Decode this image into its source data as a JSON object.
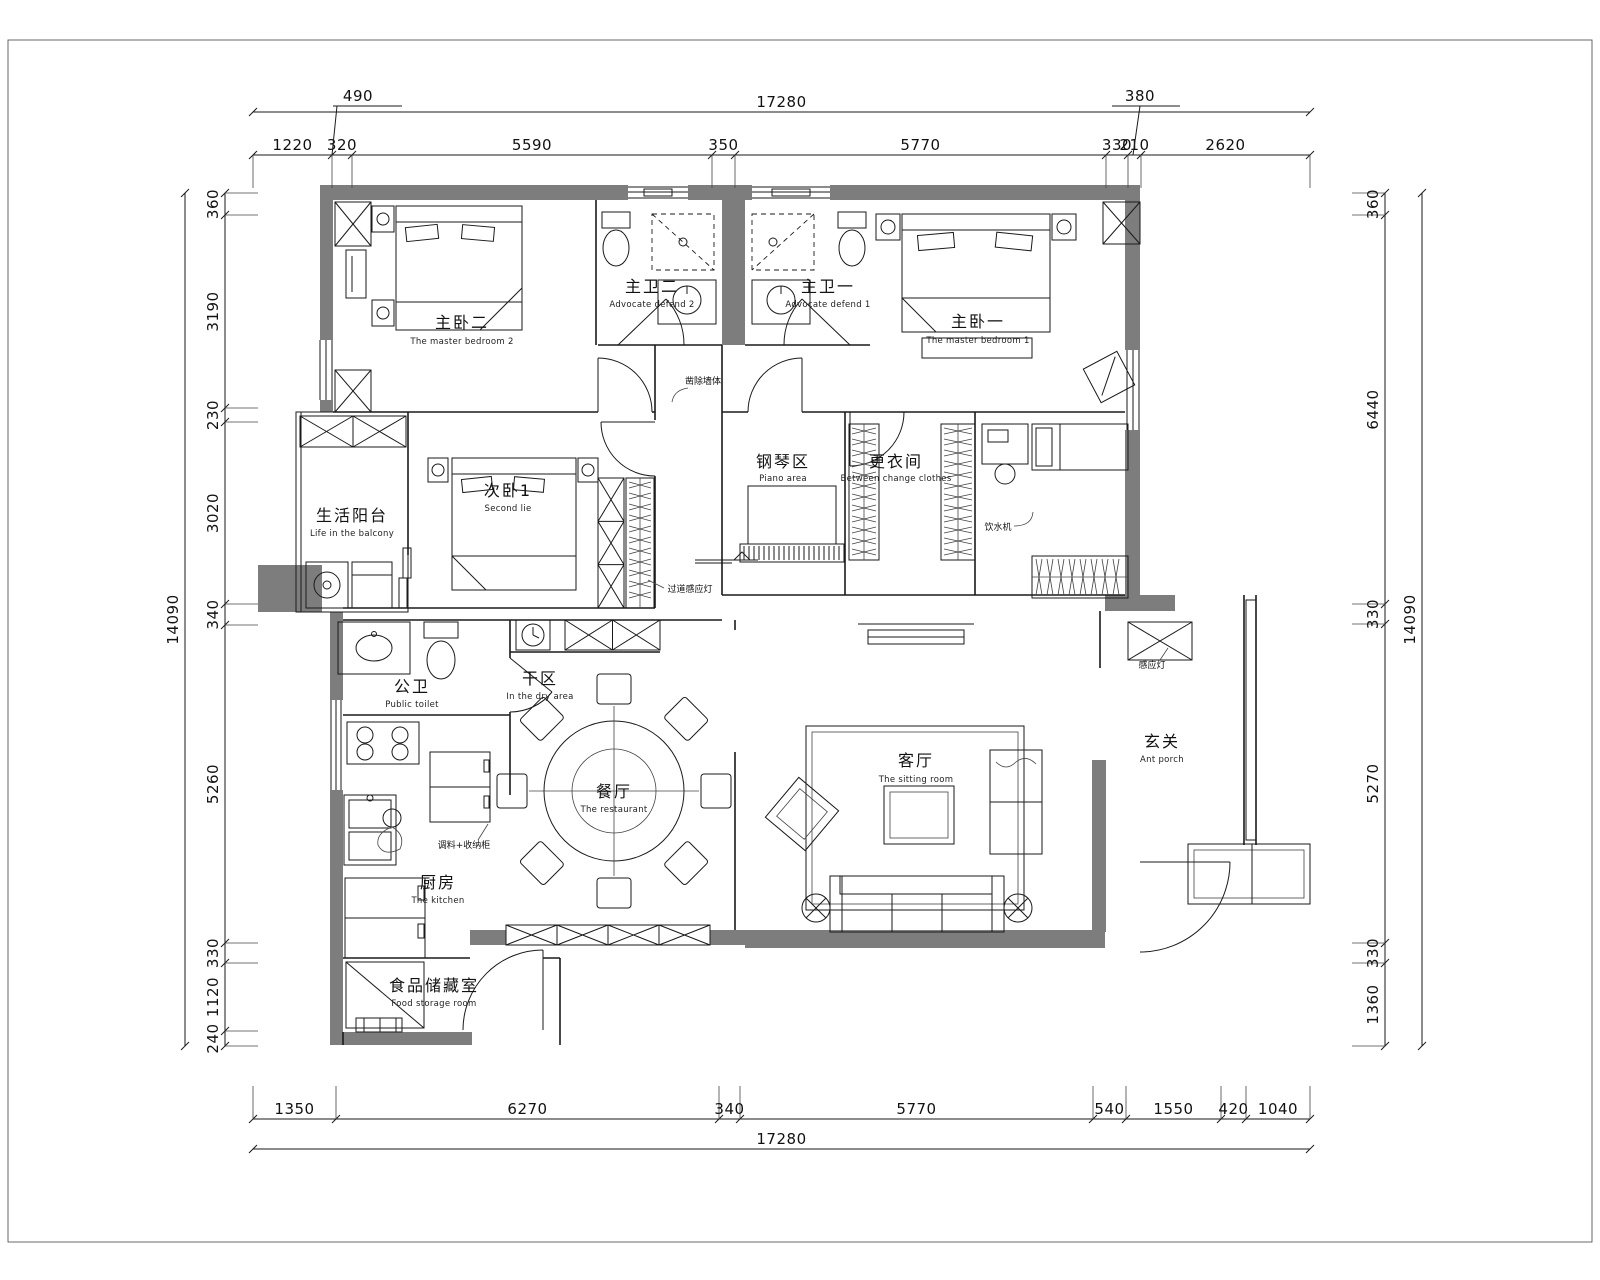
{
  "drawing": {
    "type": "residential-floor-plan",
    "units": "mm",
    "colors": {
      "wall_fill": "#7d7d7d",
      "line": "#1a1a1a",
      "background": "#ffffff"
    },
    "dimensions": {
      "top": {
        "overall": "17280",
        "offset_left": "490",
        "offset_right": "380",
        "chain": [
          "1220",
          "320",
          "5590",
          "350",
          "5770",
          "330",
          "210",
          "2620"
        ]
      },
      "bottom": {
        "overall": "17280",
        "chain": [
          "1350",
          "6270",
          "340",
          "5770",
          "540",
          "1550",
          "420",
          "1040"
        ]
      },
      "left": {
        "overall": "14090",
        "chain": [
          "360",
          "3190",
          "230",
          "3020",
          "340",
          "5260",
          "330",
          "1120",
          "240"
        ]
      },
      "right": {
        "overall": "14090",
        "chain": [
          "360",
          "6440",
          "330",
          "5270",
          "330",
          "1360"
        ]
      }
    },
    "rooms": [
      {
        "zh": "主卧二",
        "en": "The master bedroom 2"
      },
      {
        "zh": "主卫二",
        "en": "Advocate defend 2"
      },
      {
        "zh": "主卫一",
        "en": "Advocate defend 1"
      },
      {
        "zh": "主卧一",
        "en": "The master bedroom 1"
      },
      {
        "zh": "次卧1",
        "en": "Second lie"
      },
      {
        "zh": "生活阳台",
        "en": "Life in the balcony"
      },
      {
        "zh": "钢琴区",
        "en": "Piano area"
      },
      {
        "zh": "更衣间",
        "en": "Between change clothes"
      },
      {
        "zh": "公卫",
        "en": "Public toilet"
      },
      {
        "zh": "干区",
        "en": "In the dry area"
      },
      {
        "zh": "餐厅",
        "en": "The restaurant"
      },
      {
        "zh": "客厅",
        "en": "The sitting room"
      },
      {
        "zh": "厨房",
        "en": "The kitchen"
      },
      {
        "zh": "玄关",
        "en": "Ant porch"
      },
      {
        "zh": "食品储藏室",
        "en": "Food storage room"
      }
    ],
    "annotations": [
      {
        "text": "凿除墙体"
      },
      {
        "text": "饮水机"
      },
      {
        "text": "过道感应灯"
      },
      {
        "text": "调料+收纳柜"
      },
      {
        "text": "感应灯"
      }
    ]
  }
}
